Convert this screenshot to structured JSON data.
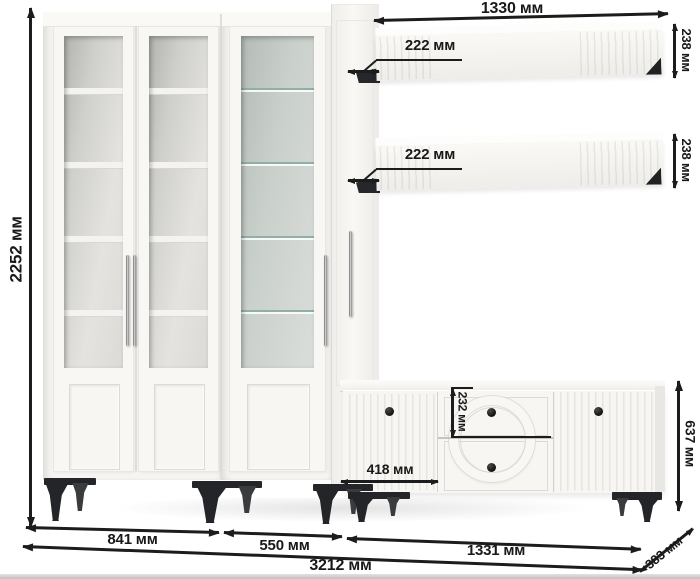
{
  "diagram": {
    "kind": "wall-unit-furniture-dimension-diagram",
    "unit": "мм",
    "labels": {
      "total_height": "2252 мм",
      "shelf_length": "1330 мм",
      "shelf1_depth": "222 мм",
      "shelf2_depth": "222 мм",
      "shelf1_thickness": "238 мм",
      "shelf2_thickness": "238 мм",
      "drawer_height": "232 мм",
      "tv_left_door_width": "418 мм",
      "tv_stand_height": "637 мм",
      "bookcase_width": "841 мм",
      "display_cabinet_width": "550 мм",
      "tv_stand_width": "1331 мм",
      "total_width": "3212 мм",
      "depth": "383 мм"
    },
    "colors": {
      "furniture_white": "#f6f5f2",
      "interior_back": "#cfcfcb",
      "glass_back": "#c9cfcb",
      "glass_shelf_edge": "#8fafa8",
      "leg_black": "#232528",
      "dimension_ink": "#1c1c1c"
    }
  }
}
